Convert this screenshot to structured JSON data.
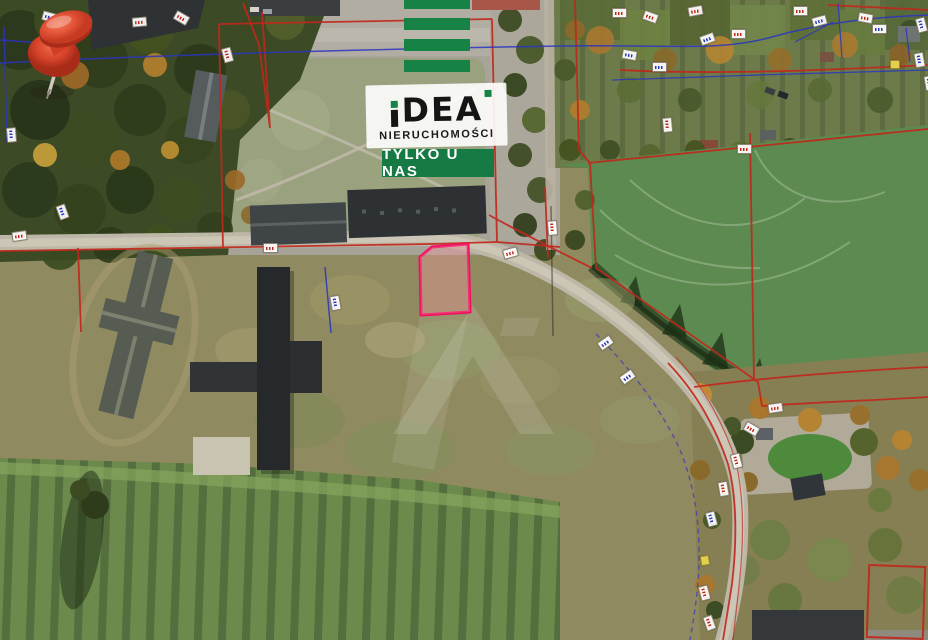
{
  "theme": {
    "brand-green": "#178245",
    "badge-green": "#157a43",
    "plot-pink": "#f01060",
    "cadastral-red": "#c1271b",
    "cadastral-blue": "#2a35c0",
    "boundary-purple": "#4a3fb0",
    "pin-red": "#e2492f"
  },
  "watermark": {
    "brand": "IDEA",
    "brand_tail": "DEA",
    "subtitle": "NIERUCHOMOŚCI",
    "badge": "TYLKO U NAS",
    "glyph": "A"
  },
  "map": {
    "type": "satellite-aerial",
    "marker": {
      "shape": "pushpin",
      "x": 460,
      "y": 228
    },
    "highlighted_plot": {
      "outline_color": "#f01060",
      "vertices": [
        [
          432,
          247
        ],
        [
          468,
          244
        ],
        [
          470,
          312
        ],
        [
          421,
          315
        ],
        [
          420,
          257
        ]
      ]
    },
    "parcel_labels": [
      {
        "x": 12,
        "y": 231,
        "r": -8,
        "c": "red"
      },
      {
        "x": 55,
        "y": 207,
        "r": 70,
        "c": "blue"
      },
      {
        "x": 4,
        "y": 130,
        "r": 85,
        "c": "blue"
      },
      {
        "x": 42,
        "y": 12,
        "r": 15,
        "c": "blue"
      },
      {
        "x": 132,
        "y": 17,
        "r": -5,
        "c": "red"
      },
      {
        "x": 174,
        "y": 13,
        "r": 30,
        "c": "red"
      },
      {
        "x": 220,
        "y": 50,
        "r": 75,
        "c": "red"
      },
      {
        "x": 612,
        "y": 8,
        "r": 0,
        "c": "red"
      },
      {
        "x": 643,
        "y": 12,
        "r": 20,
        "c": "red"
      },
      {
        "x": 688,
        "y": 6,
        "r": -10,
        "c": "red"
      },
      {
        "x": 731,
        "y": 29,
        "r": 0,
        "c": "red"
      },
      {
        "x": 793,
        "y": 6,
        "r": 0,
        "c": "red"
      },
      {
        "x": 858,
        "y": 13,
        "r": 10,
        "c": "red"
      },
      {
        "x": 812,
        "y": 16,
        "r": -15,
        "c": "blue"
      },
      {
        "x": 872,
        "y": 24,
        "r": 0,
        "c": "blue"
      },
      {
        "x": 914,
        "y": 20,
        "r": 75,
        "c": "blue"
      },
      {
        "x": 622,
        "y": 50,
        "r": 10,
        "c": "blue"
      },
      {
        "x": 652,
        "y": 62,
        "r": 0,
        "c": "blue"
      },
      {
        "x": 700,
        "y": 34,
        "r": -20,
        "c": "blue"
      },
      {
        "x": 890,
        "y": 60,
        "r": 0,
        "c": "yellow"
      },
      {
        "x": 912,
        "y": 55,
        "r": 80,
        "c": "blue"
      },
      {
        "x": 660,
        "y": 120,
        "r": 85,
        "c": "red"
      },
      {
        "x": 737,
        "y": 144,
        "r": 0,
        "c": "red"
      },
      {
        "x": 545,
        "y": 223,
        "r": 85,
        "c": "red"
      },
      {
        "x": 503,
        "y": 248,
        "r": -15,
        "c": "red"
      },
      {
        "x": 263,
        "y": 243,
        "r": 0,
        "c": "red"
      },
      {
        "x": 328,
        "y": 298,
        "r": 80,
        "c": "blue"
      },
      {
        "x": 768,
        "y": 403,
        "r": -8,
        "c": "red"
      },
      {
        "x": 744,
        "y": 424,
        "r": 30,
        "c": "red"
      },
      {
        "x": 729,
        "y": 456,
        "r": 75,
        "c": "red"
      },
      {
        "x": 716,
        "y": 484,
        "r": 80,
        "c": "red"
      },
      {
        "x": 704,
        "y": 514,
        "r": 75,
        "c": "blue"
      },
      {
        "x": 700,
        "y": 556,
        "r": 80,
        "c": "yellow"
      },
      {
        "x": 697,
        "y": 588,
        "r": 75,
        "c": "red"
      },
      {
        "x": 702,
        "y": 618,
        "r": 70,
        "c": "red"
      },
      {
        "x": 922,
        "y": 78,
        "r": 80,
        "c": "blue"
      },
      {
        "x": 598,
        "y": 338,
        "r": -35,
        "c": "blue"
      },
      {
        "x": 620,
        "y": 372,
        "r": -35,
        "c": "blue"
      }
    ]
  }
}
